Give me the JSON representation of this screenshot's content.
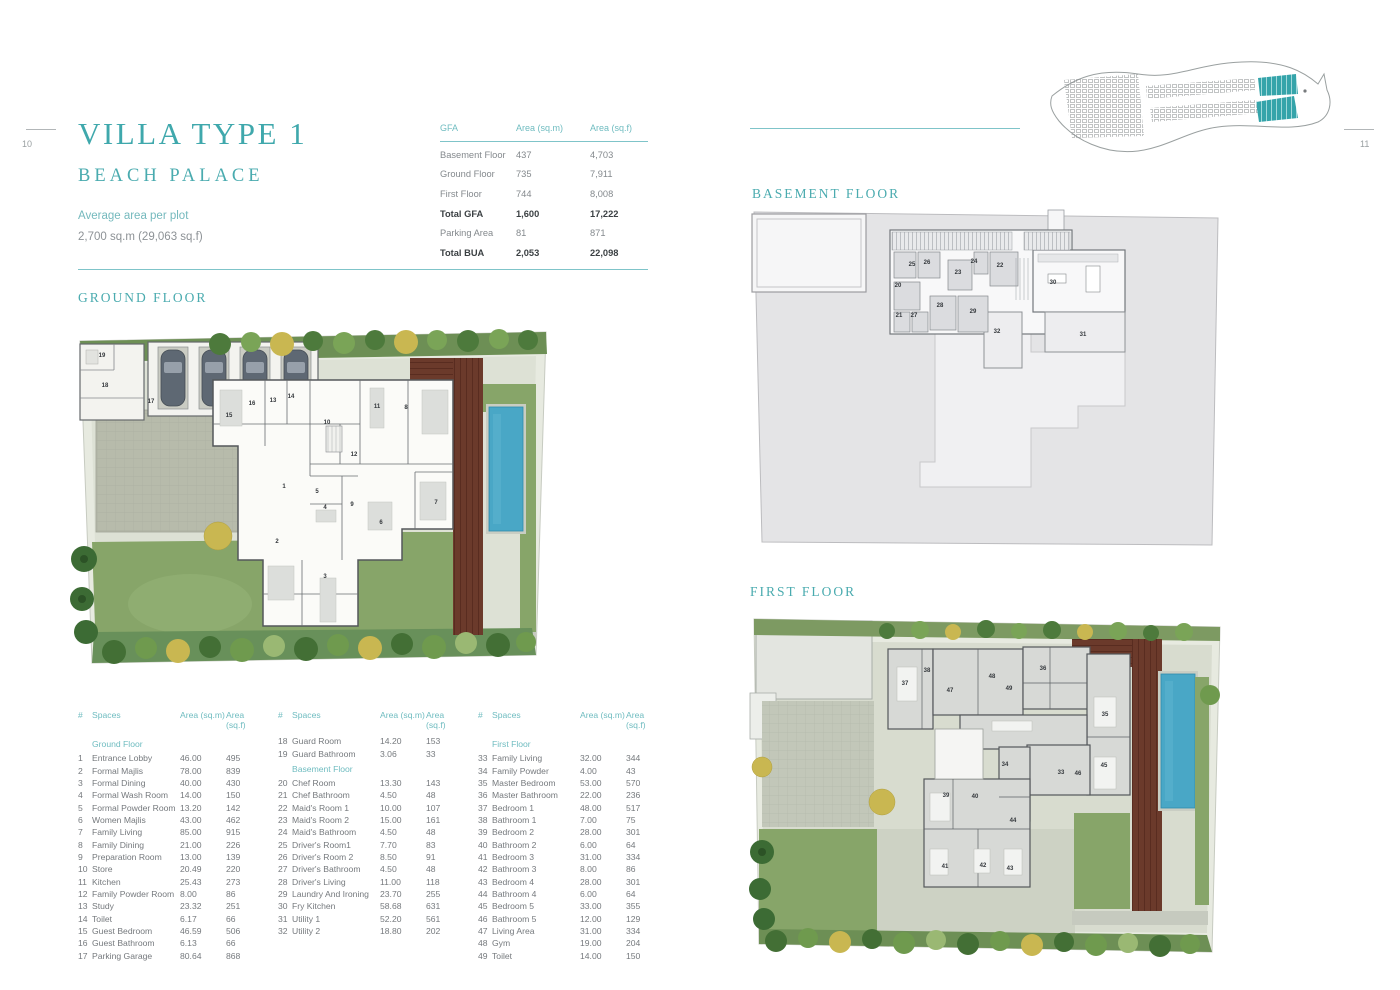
{
  "page": {
    "left_page_number": "10",
    "right_page_number": "11",
    "accent": "#3fa8ac",
    "accent_light": "#6fbcc0"
  },
  "title": {
    "line1": "VILLA TYPE 1",
    "line2": "BEACH PALACE",
    "subtitle": "Average area per plot",
    "plot_area": "2,700 sq.m (29,063 sq.f)"
  },
  "floor_headings": {
    "ground": "GROUND FLOOR",
    "basement": "BASEMENT FLOOR",
    "first": "FIRST FLOOR"
  },
  "gfa_table": {
    "headers": [
      "GFA",
      "Area (sq.m)",
      "Area (sq.f)"
    ],
    "rows": [
      {
        "label": "Basement Floor",
        "sqm": "437",
        "sqf": "4,703",
        "bold": false
      },
      {
        "label": "Ground Floor",
        "sqm": "735",
        "sqf": "7,911",
        "bold": false
      },
      {
        "label": "First Floor",
        "sqm": "744",
        "sqf": "8,008",
        "bold": false
      },
      {
        "label": "Total GFA",
        "sqm": "1,600",
        "sqf": "17,222",
        "bold": true
      },
      {
        "label": "Parking Area",
        "sqm": "81",
        "sqf": "871",
        "bold": false
      },
      {
        "label": "Total BUA",
        "sqm": "2,053",
        "sqf": "22,098",
        "bold": true
      }
    ]
  },
  "spaces_tables": [
    {
      "headers": {
        "num": "#",
        "name": "Spaces",
        "sqm": "Area (sq.m)",
        "sqf": "Area (sq.f)"
      },
      "rows": [
        {
          "section": "Ground Floor"
        },
        {
          "num": "1",
          "name": "Entrance Lobby",
          "sqm": "46.00",
          "sqf": "495"
        },
        {
          "num": "2",
          "name": "Formal Majlis",
          "sqm": "78.00",
          "sqf": "839"
        },
        {
          "num": "3",
          "name": "Formal Dining",
          "sqm": "40.00",
          "sqf": "430"
        },
        {
          "num": "4",
          "name": "Formal Wash Room",
          "sqm": "14.00",
          "sqf": "150"
        },
        {
          "num": "5",
          "name": "Formal Powder Room",
          "sqm": "13.20",
          "sqf": "142"
        },
        {
          "num": "6",
          "name": "Women Majlis",
          "sqm": "43.00",
          "sqf": "462"
        },
        {
          "num": "7",
          "name": "Family Living",
          "sqm": "85.00",
          "sqf": "915"
        },
        {
          "num": "8",
          "name": "Family Dining",
          "sqm": "21.00",
          "sqf": "226"
        },
        {
          "num": "9",
          "name": "Preparation Room",
          "sqm": "13.00",
          "sqf": "139"
        },
        {
          "num": "10",
          "name": "Store",
          "sqm": "20.49",
          "sqf": "220"
        },
        {
          "num": "11",
          "name": "Kitchen",
          "sqm": "25.43",
          "sqf": "273"
        },
        {
          "num": "12",
          "name": "Family Powder Room",
          "sqm": "8.00",
          "sqf": "86"
        },
        {
          "num": "13",
          "name": "Study",
          "sqm": "23.32",
          "sqf": "251"
        },
        {
          "num": "14",
          "name": "Toilet",
          "sqm": "6.17",
          "sqf": "66"
        },
        {
          "num": "15",
          "name": "Guest Bedroom",
          "sqm": "46.59",
          "sqf": "506"
        },
        {
          "num": "16",
          "name": "Guest Bathroom",
          "sqm": "6.13",
          "sqf": "66"
        },
        {
          "num": "17",
          "name": "Parking Garage",
          "sqm": "80.64",
          "sqf": "868"
        }
      ]
    },
    {
      "headers": {
        "num": "#",
        "name": "Spaces",
        "sqm": "Area (sq.m)",
        "sqf": "Area (sq.f)"
      },
      "rows": [
        {
          "num": "18",
          "name": "Guard Room",
          "sqm": "14.20",
          "sqf": "153"
        },
        {
          "num": "19",
          "name": "Guard Bathroom",
          "sqm": "3.06",
          "sqf": "33"
        },
        {
          "section": "Basement Floor"
        },
        {
          "num": "20",
          "name": "Chef Room",
          "sqm": "13.30",
          "sqf": "143"
        },
        {
          "num": "21",
          "name": "Chef Bathroom",
          "sqm": "4.50",
          "sqf": "48"
        },
        {
          "num": "22",
          "name": "Maid's Room 1",
          "sqm": "10.00",
          "sqf": "107"
        },
        {
          "num": "23",
          "name": "Maid's Room 2",
          "sqm": "15.00",
          "sqf": "161"
        },
        {
          "num": "24",
          "name": "Maid's Bathroom",
          "sqm": "4.50",
          "sqf": "48"
        },
        {
          "num": "25",
          "name": "Driver's Room1",
          "sqm": "7.70",
          "sqf": "83"
        },
        {
          "num": "26",
          "name": "Driver's Room 2",
          "sqm": "8.50",
          "sqf": "91"
        },
        {
          "num": "27",
          "name": "Driver's Bathroom",
          "sqm": "4.50",
          "sqf": "48"
        },
        {
          "num": "28",
          "name": "Driver's Living",
          "sqm": "11.00",
          "sqf": "118"
        },
        {
          "num": "29",
          "name": "Laundry And Ironing",
          "sqm": "23.70",
          "sqf": "255"
        },
        {
          "num": "30",
          "name": "Fry Kitchen",
          "sqm": "58.68",
          "sqf": "631"
        },
        {
          "num": "31",
          "name": "Utility 1",
          "sqm": "52.20",
          "sqf": "561"
        },
        {
          "num": "32",
          "name": "Utility 2",
          "sqm": "18.80",
          "sqf": "202"
        }
      ]
    },
    {
      "headers": {
        "num": "#",
        "name": "Spaces",
        "sqm": "Area (sq.m)",
        "sqf": "Area (sq.f)"
      },
      "rows": [
        {
          "section": "First Floor"
        },
        {
          "num": "33",
          "name": "Family Living",
          "sqm": "32.00",
          "sqf": "344"
        },
        {
          "num": "34",
          "name": "Family Powder",
          "sqm": "4.00",
          "sqf": "43"
        },
        {
          "num": "35",
          "name": "Master Bedroom",
          "sqm": "53.00",
          "sqf": "570"
        },
        {
          "num": "36",
          "name": "Master Bathroom",
          "sqm": "22.00",
          "sqf": "236"
        },
        {
          "num": "37",
          "name": "Bedroom 1",
          "sqm": "48.00",
          "sqf": "517"
        },
        {
          "num": "38",
          "name": "Bathroom 1",
          "sqm": "7.00",
          "sqf": "75"
        },
        {
          "num": "39",
          "name": "Bedroom 2",
          "sqm": "28.00",
          "sqf": "301"
        },
        {
          "num": "40",
          "name": "Bathroom 2",
          "sqm": "6.00",
          "sqf": "64"
        },
        {
          "num": "41",
          "name": "Bedroom 3",
          "sqm": "31.00",
          "sqf": "334"
        },
        {
          "num": "42",
          "name": "Bathroom 3",
          "sqm": "8.00",
          "sqf": "86"
        },
        {
          "num": "43",
          "name": "Bedroom 4",
          "sqm": "28.00",
          "sqf": "301"
        },
        {
          "num": "44",
          "name": "Bathroom 4",
          "sqm": "6.00",
          "sqf": "64"
        },
        {
          "num": "45",
          "name": "Bedroom 5",
          "sqm": "33.00",
          "sqf": "355"
        },
        {
          "num": "46",
          "name": "Bathroom 5",
          "sqm": "12.00",
          "sqf": "129"
        },
        {
          "num": "47",
          "name": "Living Area",
          "sqm": "31.00",
          "sqf": "334"
        },
        {
          "num": "48",
          "name": "Gym",
          "sqm": "19.00",
          "sqf": "204"
        },
        {
          "num": "49",
          "name": "Toilet",
          "sqm": "14.00",
          "sqf": "150"
        }
      ]
    }
  ],
  "plans": {
    "ground": {
      "labels": [
        {
          "n": "1",
          "x": 214,
          "y": 173
        },
        {
          "n": "2",
          "x": 207,
          "y": 228
        },
        {
          "n": "3",
          "x": 255,
          "y": 263
        },
        {
          "n": "4",
          "x": 255,
          "y": 194
        },
        {
          "n": "5",
          "x": 247,
          "y": 178
        },
        {
          "n": "6",
          "x": 311,
          "y": 209
        },
        {
          "n": "7",
          "x": 366,
          "y": 189
        },
        {
          "n": "8",
          "x": 336,
          "y": 94
        },
        {
          "n": "9",
          "x": 282,
          "y": 191
        },
        {
          "n": "10",
          "x": 257,
          "y": 109
        },
        {
          "n": "11",
          "x": 307,
          "y": 93
        },
        {
          "n": "12",
          "x": 284,
          "y": 141
        },
        {
          "n": "13",
          "x": 203,
          "y": 87
        },
        {
          "n": "14",
          "x": 221,
          "y": 83
        },
        {
          "n": "15",
          "x": 159,
          "y": 102
        },
        {
          "n": "16",
          "x": 182,
          "y": 90
        },
        {
          "n": "17",
          "x": 81,
          "y": 88
        },
        {
          "n": "18",
          "x": 35,
          "y": 72
        },
        {
          "n": "19",
          "x": 32,
          "y": 42
        }
      ]
    },
    "basement": {
      "labels": [
        {
          "n": "20",
          "x": 150,
          "y": 82
        },
        {
          "n": "21",
          "x": 151,
          "y": 112
        },
        {
          "n": "22",
          "x": 252,
          "y": 62
        },
        {
          "n": "23",
          "x": 210,
          "y": 69
        },
        {
          "n": "24",
          "x": 226,
          "y": 58
        },
        {
          "n": "25",
          "x": 164,
          "y": 61
        },
        {
          "n": "26",
          "x": 179,
          "y": 59
        },
        {
          "n": "27",
          "x": 166,
          "y": 112
        },
        {
          "n": "28",
          "x": 192,
          "y": 102
        },
        {
          "n": "29",
          "x": 225,
          "y": 108
        },
        {
          "n": "30",
          "x": 305,
          "y": 79
        },
        {
          "n": "31",
          "x": 335,
          "y": 131
        },
        {
          "n": "32",
          "x": 249,
          "y": 128
        }
      ]
    },
    "first": {
      "labels": [
        {
          "n": "33",
          "x": 319,
          "y": 176
        },
        {
          "n": "34",
          "x": 263,
          "y": 168
        },
        {
          "n": "35",
          "x": 363,
          "y": 118
        },
        {
          "n": "36",
          "x": 301,
          "y": 72
        },
        {
          "n": "37",
          "x": 163,
          "y": 87
        },
        {
          "n": "38",
          "x": 185,
          "y": 74
        },
        {
          "n": "39",
          "x": 204,
          "y": 199
        },
        {
          "n": "40",
          "x": 233,
          "y": 200
        },
        {
          "n": "41",
          "x": 203,
          "y": 270
        },
        {
          "n": "42",
          "x": 241,
          "y": 269
        },
        {
          "n": "43",
          "x": 268,
          "y": 272
        },
        {
          "n": "44",
          "x": 271,
          "y": 224
        },
        {
          "n": "45",
          "x": 362,
          "y": 169
        },
        {
          "n": "46",
          "x": 336,
          "y": 177
        },
        {
          "n": "47",
          "x": 208,
          "y": 94
        },
        {
          "n": "48",
          "x": 250,
          "y": 80
        },
        {
          "n": "49",
          "x": 267,
          "y": 92
        }
      ]
    }
  }
}
